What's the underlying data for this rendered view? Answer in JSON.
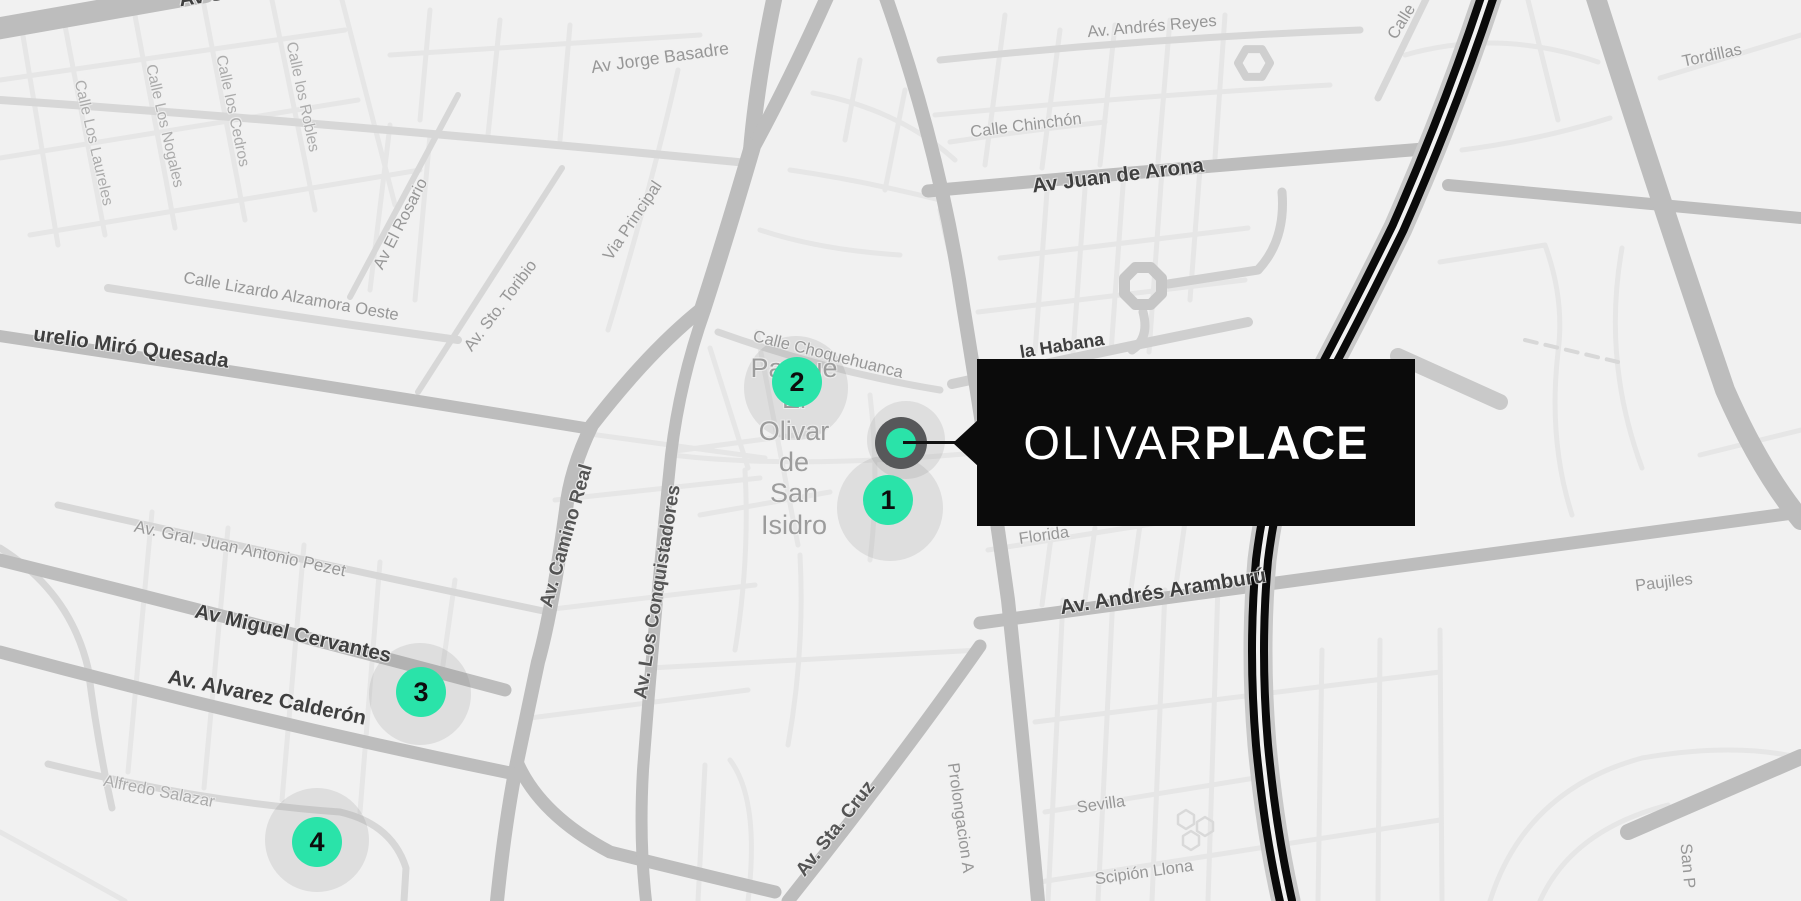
{
  "map": {
    "colors": {
      "accent": "#2ae3a9",
      "callout_bg": "#0b0b0b",
      "railway": "#0a0a0a",
      "background": "#f1f1f1"
    },
    "labels": [
      {
        "t": "Av Sa",
        "x": 207,
        "y": -4,
        "r": -9,
        "s": "major"
      },
      {
        "t": "Calle Los Laureles",
        "x": 93,
        "y": 143,
        "r": 77,
        "s": "minor"
      },
      {
        "t": "Calle Los Nogales",
        "x": 164,
        "y": 126,
        "r": 77,
        "s": "minor"
      },
      {
        "t": "Calle los Cedros",
        "x": 232,
        "y": 111,
        "r": 78,
        "s": "minor"
      },
      {
        "t": "Calle los Robles",
        "x": 302,
        "y": 97,
        "r": 78,
        "s": "minor"
      },
      {
        "t": "Av Jorge Basadre",
        "x": 660,
        "y": 58,
        "r": -8,
        "s": "medium",
        "fs": 17.5
      },
      {
        "t": "Av El Rosario",
        "x": 401,
        "y": 224,
        "r": -63,
        "s": "medium"
      },
      {
        "t": "Av. Sto. Toribio",
        "x": 501,
        "y": 306,
        "r": -53,
        "s": "medium"
      },
      {
        "t": "Via Principal",
        "x": 633,
        "y": 221,
        "r": -56,
        "s": "medium"
      },
      {
        "t": "Calle Lizardo Alzamora Oeste",
        "x": 291,
        "y": 297,
        "r": 10,
        "s": "medium"
      },
      {
        "t": "urelio Miró Quesada",
        "x": 131,
        "y": 348,
        "r": 8,
        "s": "major"
      },
      {
        "t": "Av. Andrés Reyes",
        "x": 1152,
        "y": 27,
        "r": -5,
        "s": "medium"
      },
      {
        "t": "Calle Chinchón",
        "x": 1026,
        "y": 126,
        "r": -7,
        "s": "medium"
      },
      {
        "t": "Av Juan de Arona",
        "x": 1118,
        "y": 176,
        "r": -7,
        "s": "major"
      },
      {
        "t": "Calle",
        "x": 1402,
        "y": 22,
        "r": -58,
        "s": "medium"
      },
      {
        "t": "Tordillas",
        "x": 1712,
        "y": 56,
        "r": -12,
        "s": "medium"
      },
      {
        "t": "Calle Choquehuanca",
        "x": 828,
        "y": 355,
        "r": 14,
        "s": "medium"
      },
      {
        "t": "Parque El\nOlivar de\nSan Isidro",
        "x": 794,
        "y": 447,
        "r": 0,
        "s": "park"
      },
      {
        "t": "la Habana",
        "x": 1062,
        "y": 346,
        "r": -9,
        "s": "major",
        "fs": 18
      },
      {
        "t": "Florida",
        "x": 1044,
        "y": 536,
        "r": -8,
        "s": "medium"
      },
      {
        "t": "Av. Andrés Aramburú",
        "x": 1163,
        "y": 592,
        "r": -9,
        "s": "major"
      },
      {
        "t": "Paujiles",
        "x": 1664,
        "y": 583,
        "r": -7,
        "s": "medium"
      },
      {
        "t": "Av. Gral. Juan Antonio Pezet",
        "x": 240,
        "y": 549,
        "r": 12,
        "s": "medium",
        "fs": 17
      },
      {
        "t": "Av Miguel Cervantes",
        "x": 293,
        "y": 634,
        "r": 13,
        "s": "major"
      },
      {
        "t": "Av. Alvarez Calderón",
        "x": 267,
        "y": 698,
        "r": 12,
        "s": "major"
      },
      {
        "t": "Alfredo Salazar",
        "x": 159,
        "y": 792,
        "r": 11,
        "s": "minor",
        "fs": 16.5
      },
      {
        "t": "Av. Camino Real",
        "x": 567,
        "y": 536,
        "r": -74,
        "s": "softmajor"
      },
      {
        "t": "Av. Los Conquistadores",
        "x": 658,
        "y": 592,
        "r": -81,
        "s": "softmajor"
      },
      {
        "t": "Av. Sta. Cruz",
        "x": 836,
        "y": 829,
        "r": -52,
        "s": "softmajor"
      },
      {
        "t": "Prolongacion A",
        "x": 960,
        "y": 818,
        "r": 82,
        "s": "medium"
      },
      {
        "t": "Sevilla",
        "x": 1101,
        "y": 805,
        "r": -8,
        "s": "medium"
      },
      {
        "t": "Scipión Llona",
        "x": 1144,
        "y": 873,
        "r": -8,
        "s": "medium"
      },
      {
        "t": "San P",
        "x": 1687,
        "y": 866,
        "r": 85,
        "s": "medium"
      }
    ],
    "markers": [
      {
        "n": "1",
        "x": 888,
        "y": 500,
        "hx": 890,
        "hy": 508,
        "hr": 53
      },
      {
        "n": "2",
        "x": 797,
        "y": 382,
        "hx": 796,
        "hy": 388,
        "hr": 52
      },
      {
        "n": "3",
        "x": 421,
        "y": 692,
        "hx": 420,
        "hy": 694,
        "hr": 51
      },
      {
        "n": "4",
        "x": 317,
        "y": 842,
        "hx": 317,
        "hy": 840,
        "hr": 52
      }
    ],
    "main_marker": {
      "x": 901,
      "y": 443,
      "hx": 906,
      "hy": 440,
      "hr": 39
    },
    "callout": {
      "brand_light": "OLIVAR",
      "brand_bold": "PLACE"
    }
  }
}
